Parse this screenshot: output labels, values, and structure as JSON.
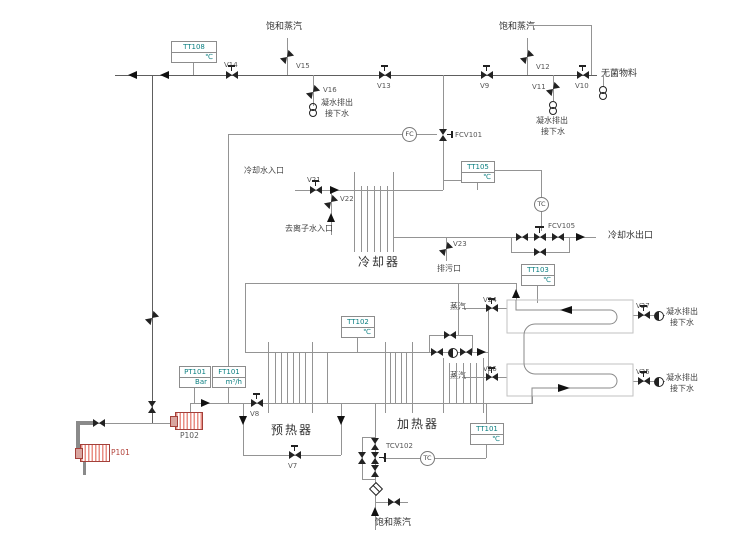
{
  "streams": {
    "saturated_steam": "饱和蒸汽",
    "sterile_material": "无菌物料",
    "condensate_1": "凝水排出",
    "condensate_2": "接下水",
    "cooling_water_in": "冷却水入口",
    "cooling_water_out": "冷却水出口",
    "di_water_in": "去离子水入口",
    "drain_port": "排污口",
    "steam": "蒸汽"
  },
  "equipment": {
    "cooler": "冷却器",
    "preheater": "预热器",
    "heater": "加热器",
    "pump1": "P101",
    "pump2": "P102"
  },
  "valves": {
    "v7": "V7",
    "v8": "V8",
    "v9": "V9",
    "v10": "V10",
    "v11": "V11",
    "v12": "V12",
    "v13": "V13",
    "v14": "V14",
    "v15": "V15",
    "v16": "V16",
    "v21": "V21",
    "v22": "V22",
    "v23": "V23",
    "v24": "V24",
    "v25": "V25",
    "v26": "V26",
    "v27": "V27"
  },
  "control_valves": {
    "fcv101": "FCV101",
    "fcv105": "FCV105",
    "tcv102": "TCV102"
  },
  "controllers": {
    "fc": "FC",
    "tc": "TC"
  },
  "instruments": {
    "tt108": {
      "tag": "TT108",
      "unit": "℃"
    },
    "tt105": {
      "tag": "TT105",
      "unit": "℃"
    },
    "tt103": {
      "tag": "TT103",
      "unit": "℃"
    },
    "tt102": {
      "tag": "TT102",
      "unit": "℃"
    },
    "tt101": {
      "tag": "TT101",
      "unit": "℃"
    },
    "pt101": {
      "tag": "PT101",
      "unit": "Bar"
    },
    "ft101": {
      "tag": "FT101",
      "unit": "m³/h"
    }
  }
}
